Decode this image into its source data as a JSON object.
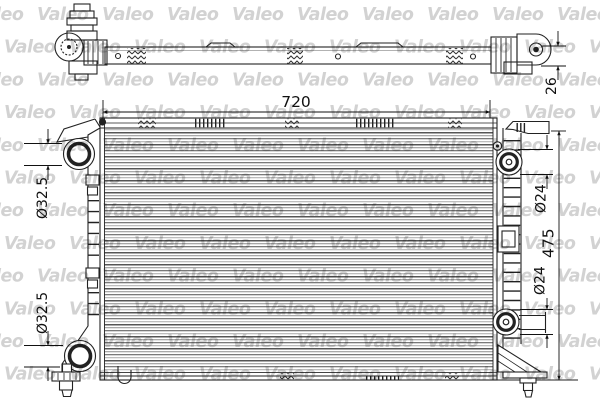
{
  "watermark": {
    "text": "Valeo"
  },
  "dimensions": {
    "core_width": "720",
    "core_height": "475",
    "tank_depth": "26",
    "left_upper_port": "Ø32.5",
    "left_lower_port": "Ø32.5",
    "right_upper_port": "Ø24",
    "right_lower_port": "Ø24"
  },
  "colors": {
    "line": "#1a1a1a",
    "watermark": "#d2d2d2",
    "background": "#ffffff"
  }
}
